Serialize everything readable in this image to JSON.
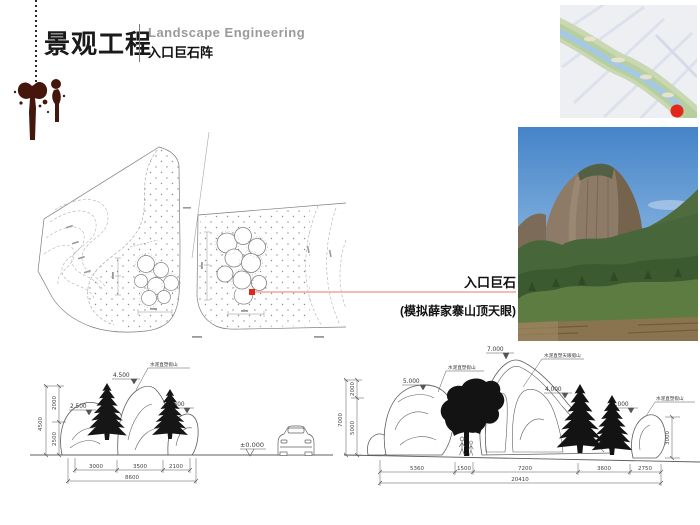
{
  "header": {
    "title_cn": "景观工程",
    "title_en": "Landscape Engineering",
    "subtitle": "入口巨石阵"
  },
  "callout": {
    "label": "入口巨石",
    "note": "(模拟薛家寨山顶天眼)"
  },
  "sections": {
    "datum": "±0.000",
    "left": {
      "material": "水泥直塑假山",
      "marks": [
        "2.500",
        "4.500",
        "2.500"
      ],
      "v_total": "4500",
      "v_dims": [
        "2000",
        "2500"
      ],
      "h_dims": [
        "3000",
        "3500",
        "2100"
      ],
      "h_total": "8600"
    },
    "right": {
      "materials": [
        "水泥直塑假山",
        "水泥直塑天眼假山",
        "水泥直塑假山"
      ],
      "marks": [
        "5.000",
        "7.000",
        "4.000",
        "3.000"
      ],
      "v_total": "7000",
      "v_dims": [
        "2000",
        "5000"
      ],
      "side_dim": "3000",
      "h_dims": [
        "5360",
        "1500",
        "7200",
        "3600",
        "2750"
      ],
      "h_total": "20410"
    }
  },
  "colors": {
    "ink_splat": "#45160c",
    "title_gray": "#9a9a9a",
    "marker_red": "#e0281c",
    "callout_line": "#ef948c",
    "drawing_gray": "#6f6f6f"
  }
}
